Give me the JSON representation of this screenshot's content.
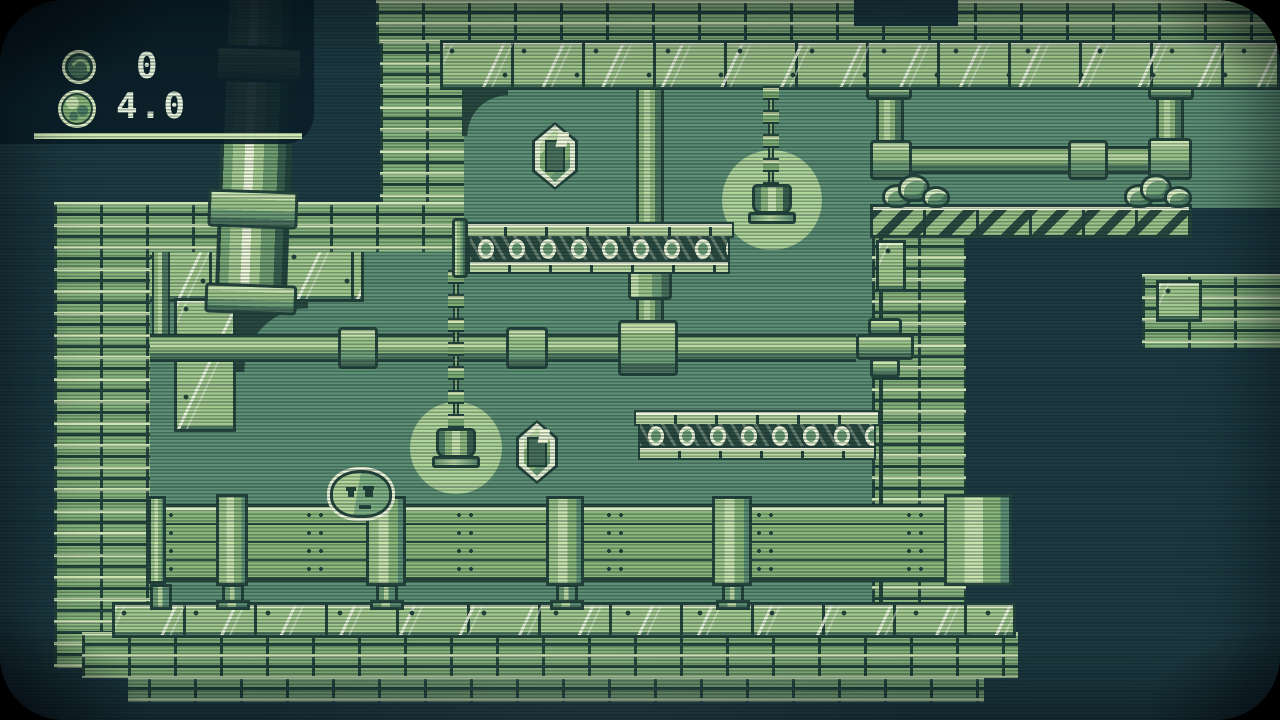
{
  "screen": {
    "type": "retro-platformer-game",
    "resolution": "1280x720",
    "style": "gameboy-green-crt"
  },
  "hud": {
    "coin_count": "0",
    "gauge_value": "4.0",
    "icons": {
      "coin": "coin-icon",
      "ball": "moss-ball-icon"
    }
  },
  "palette": {
    "void": "#1d3a42",
    "interior": "#5d8f74",
    "brick": "#85b27a",
    "tile_light": "#a9cd92",
    "highlight": "#eef7da",
    "outline": "#24443c",
    "glow": "#b0d59a",
    "hud_panel": "#0a1e28",
    "hud_text": "#e9f5de",
    "hud_underline": "#cfe8b4"
  },
  "entities": {
    "player": "blob-character",
    "collectibles": [
      "crystal-gem",
      "crystal-gem"
    ],
    "lanterns": [
      "hanging-chain-lantern",
      "hanging-chain-lantern"
    ],
    "hazards": [
      "roller-belt",
      "roller-belt"
    ],
    "platforms": [
      "hatched-girder-platform",
      "wooden-fence-walkway"
    ],
    "decor": [
      "brick-walls",
      "metal-plate-beams",
      "pipes",
      "bushes"
    ]
  }
}
